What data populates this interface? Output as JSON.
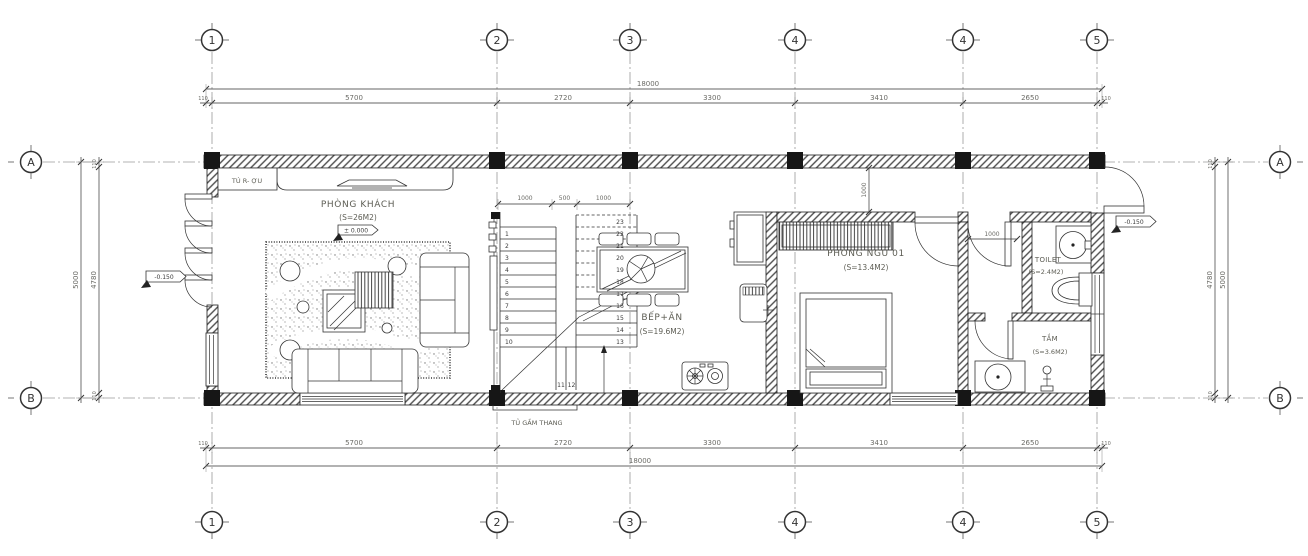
{
  "drawing": {
    "type": "ground-floor-plan"
  },
  "grid": {
    "columns": [
      "1",
      "2",
      "3",
      "4",
      "4",
      "5"
    ],
    "rows": [
      "A",
      "B"
    ]
  },
  "dims": {
    "overall_width": "18000",
    "width_segments": [
      "110",
      "5700",
      "2720",
      "3300",
      "3410",
      "2650",
      "110"
    ],
    "overall_height": "5000",
    "height_inner": "4780",
    "height_offset": "110",
    "stair_segments": [
      "1000",
      "500",
      "1000"
    ],
    "hall_depth": "1000",
    "vestibule_width": "1000"
  },
  "levels": {
    "ground": "± 0.000",
    "entry": "-0.150"
  },
  "rooms": {
    "living": {
      "name": "PHÒNG KHÁCH",
      "area": "(S=26M2)"
    },
    "kitchen": {
      "name": "BẾP+ĂN",
      "area": "(S=19.6M2)"
    },
    "bedroom": {
      "name": "PHÒNG NGỦ 01",
      "area": "(S=13.4M2)"
    },
    "toilet": {
      "name": "TOILET",
      "area": "(S=2.4M2)"
    },
    "bath": {
      "name": "TẮM",
      "area": "(S=3.6M2)"
    }
  },
  "fixtures": {
    "wine_cabinet": "TÚ R- ỢU",
    "under_stair_cabinet": "TỦ GẦM THANG"
  },
  "stairs": {
    "numbers": [
      "1",
      "2",
      "3",
      "4",
      "5",
      "6",
      "7",
      "8",
      "9",
      "10",
      "11",
      "12",
      "13",
      "14",
      "15",
      "16",
      "17",
      "18",
      "19",
      "20",
      "21",
      "22",
      "23"
    ]
  }
}
